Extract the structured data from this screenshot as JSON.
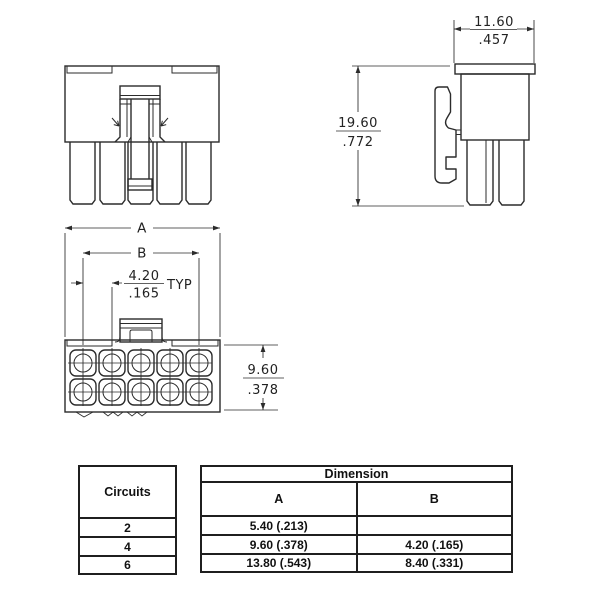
{
  "drawing": {
    "side_view": {
      "top_width_mm": "11.60",
      "top_width_in": ".457",
      "overall_height_mm": "19.60",
      "overall_height_in": ".772"
    },
    "face_view": {
      "dim_a_label": "A",
      "dim_b_label": "B",
      "pitch_mm": "4.20",
      "pitch_in": ".165",
      "pitch_suffix": "TYP",
      "row_span_mm": "9.60",
      "row_span_in": ".378"
    }
  },
  "table": {
    "circuits_header": "Circuits",
    "dimension_header": "Dimension",
    "col_a_label": "A",
    "col_b_label": "B",
    "rows": [
      {
        "circuits": "2",
        "a": "5.40 (.213)",
        "b": ""
      },
      {
        "circuits": "4",
        "a": "9.60 (.378)",
        "b": "4.20 (.165)"
      },
      {
        "circuits": "6",
        "a": "13.80 (.543)",
        "b": "8.40 (.331)"
      }
    ]
  },
  "colors": {
    "line": "#2b2b2b",
    "background": "#ffffff"
  }
}
